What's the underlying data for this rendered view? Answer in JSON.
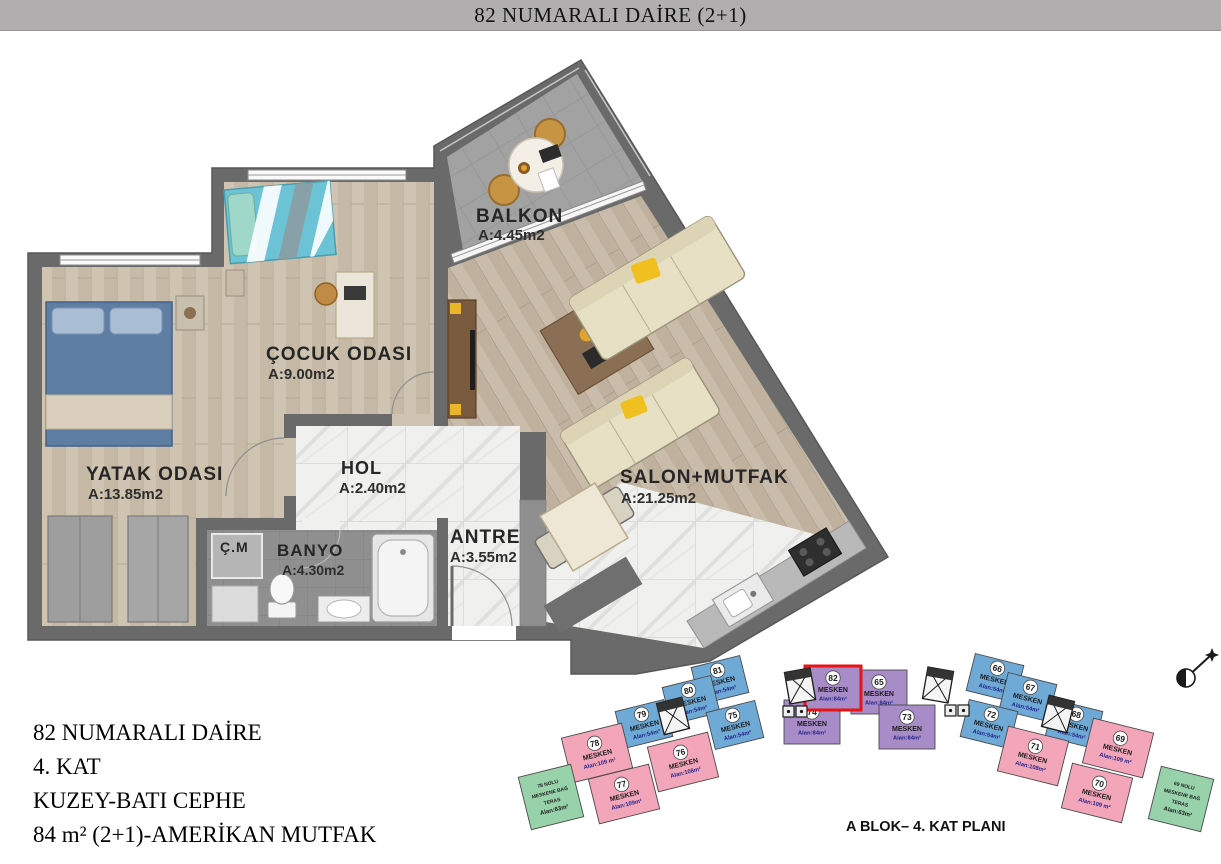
{
  "header": {
    "title": "82 NUMARALI DAİRE (2+1)"
  },
  "plan": {
    "rooms": [
      {
        "name": "BALKON",
        "area": "A:4.45m2"
      },
      {
        "name": "ÇOCUK ODASI",
        "area": "A:9.00m2"
      },
      {
        "name": "YATAK ODASI",
        "area": "A:13.85m2"
      },
      {
        "name": "HOL",
        "area": "A:2.40m2"
      },
      {
        "name": "ANTRE",
        "area": "A:3.55m2"
      },
      {
        "name": "BANYO",
        "area": "A:4.30m2"
      },
      {
        "name": "SALON+MUTFAK",
        "area": "A:21.25m2"
      },
      {
        "name": "Ç.M",
        "area": ""
      }
    ]
  },
  "info": {
    "lines": [
      "82 NUMARALI DAİRE",
      "4. KAT",
      "KUZEY-BATI CEPHE",
      "84 m² (2+1)-AMERİKAN MUTFAK"
    ]
  },
  "keyplan": {
    "caption": "A BLOK– 4. KAT PLANI",
    "colors": {
      "unit54": "#6fa9d6",
      "unit109": "#f3a6ba",
      "unit84": "#a78cc7",
      "teras": "#97d2aa",
      "highlight": "#e81313"
    },
    "units": [
      {
        "num": "81",
        "label": "MESKEN",
        "area": "Alan:54m²",
        "type": "unit54"
      },
      {
        "num": "80",
        "label": "MESKEN",
        "area": "Alan:54m²",
        "type": "unit54"
      },
      {
        "num": "79",
        "label": "MESKEN",
        "area": "Alan:54m²",
        "type": "unit54"
      },
      {
        "num": "75",
        "label": "MESKEN",
        "area": "Alan:54m²",
        "type": "unit54"
      },
      {
        "num": "78",
        "label": "MESKEN",
        "area": "Alan:109 m²",
        "type": "unit109"
      },
      {
        "num": "76",
        "label": "MESKEN",
        "area": "Alan:108m²",
        "type": "unit109"
      },
      {
        "num": "77",
        "label": "MESKEN",
        "area": "Alan:109m²",
        "type": "unit109"
      },
      {
        "num": "66",
        "label": "MESKEN",
        "area": "Alan:54m²",
        "type": "unit54"
      },
      {
        "num": "67",
        "label": "MESKEN",
        "area": "Alan:54m²",
        "type": "unit54"
      },
      {
        "num": "68",
        "label": "MESKEN",
        "area": "Alan:54m²",
        "type": "unit54"
      },
      {
        "num": "72",
        "label": "MESKEN",
        "area": "Alan:54m²",
        "type": "unit54"
      },
      {
        "num": "71",
        "label": "MESKEN",
        "area": "Alan:108m²",
        "type": "unit109"
      },
      {
        "num": "69",
        "label": "MESKEN",
        "area": "Alan:109 m²",
        "type": "unit109"
      },
      {
        "num": "70",
        "label": "MESKEN",
        "area": "Alan:109 m²",
        "type": "unit109"
      },
      {
        "num": "65",
        "label": "MESKEN",
        "area": "Alan:84m²",
        "type": "unit84"
      },
      {
        "num": "74",
        "label": "MESKEN",
        "area": "Alan:84m²",
        "type": "unit84"
      },
      {
        "num": "73",
        "label": "MESKEN",
        "area": "Alan:84m²",
        "type": "unit84"
      },
      {
        "num": "82",
        "label": "MESKEN",
        "area": "Alan:84m²",
        "type": "unit84",
        "highlighted": true
      }
    ],
    "teras": [
      {
        "lines": [
          "78 NOLU",
          "MESKENE BAĞ",
          "TERAS",
          "Alan:63m²"
        ]
      },
      {
        "lines": [
          "69 NOLU",
          "MESKENE BAĞ",
          "TERAS",
          "Alan:63m²"
        ]
      }
    ]
  }
}
